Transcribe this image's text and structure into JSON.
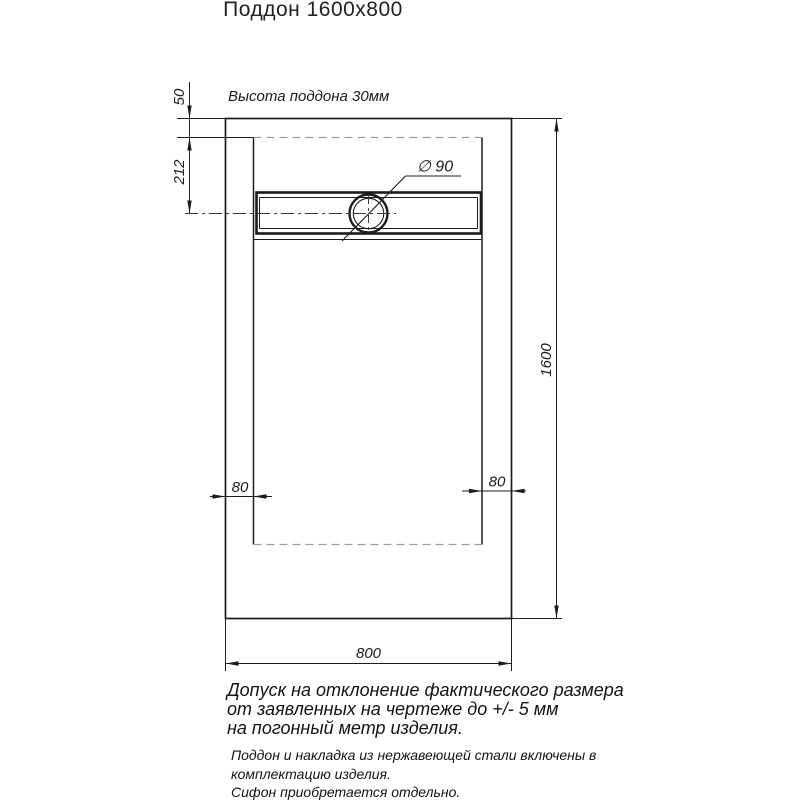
{
  "title": "Поддон 1600x800",
  "drawing": {
    "height_note": "Высота поддона 30мм",
    "dimensions": {
      "rim_offset_top": "50",
      "drain_axis_offset": "212",
      "drain_diameter": "∅ 90",
      "length": "1600",
      "side_margin_left": "80",
      "side_margin_right": "80",
      "width": "800"
    },
    "colors": {
      "line": "#1c1c1c",
      "hidden_line": "#9e9e9e",
      "background": "#ffffff"
    }
  },
  "notes": {
    "tolerance_lines": [
      "Допуск на отклонение фактического размера",
      "от заявленных на чертеже до +/- 5 мм",
      "на погонный метр изделия."
    ],
    "included_lines": [
      "Поддон и накладка из нержавеющей стали включены в",
      "комплектацию изделия."
    ],
    "siphon_line": "Сифон приобретается отдельно."
  }
}
